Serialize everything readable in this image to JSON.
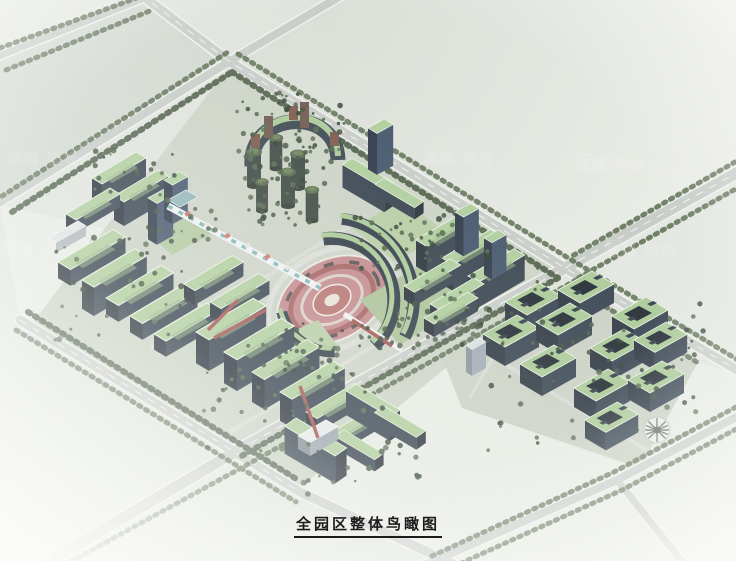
{
  "caption": {
    "text": "全园区整体鸟瞰图"
  },
  "watermark": {
    "logo_icon": "swoosh-leaf-logo",
    "brand_text": "自播",
    "secondary_text": "模板"
  },
  "colors": {
    "background": "#dfe3dc",
    "road": "#c7cbc6",
    "road_edge": "#eef0ed",
    "roof_green": "#aecd9c",
    "facade_dark": "#35414d",
    "facade_shadow": "#272f39",
    "tree_dark": "#42543e",
    "plaza_pink": "#c2888b",
    "path_red": "#a4534f",
    "caption_text": "#1c1c1c"
  }
}
